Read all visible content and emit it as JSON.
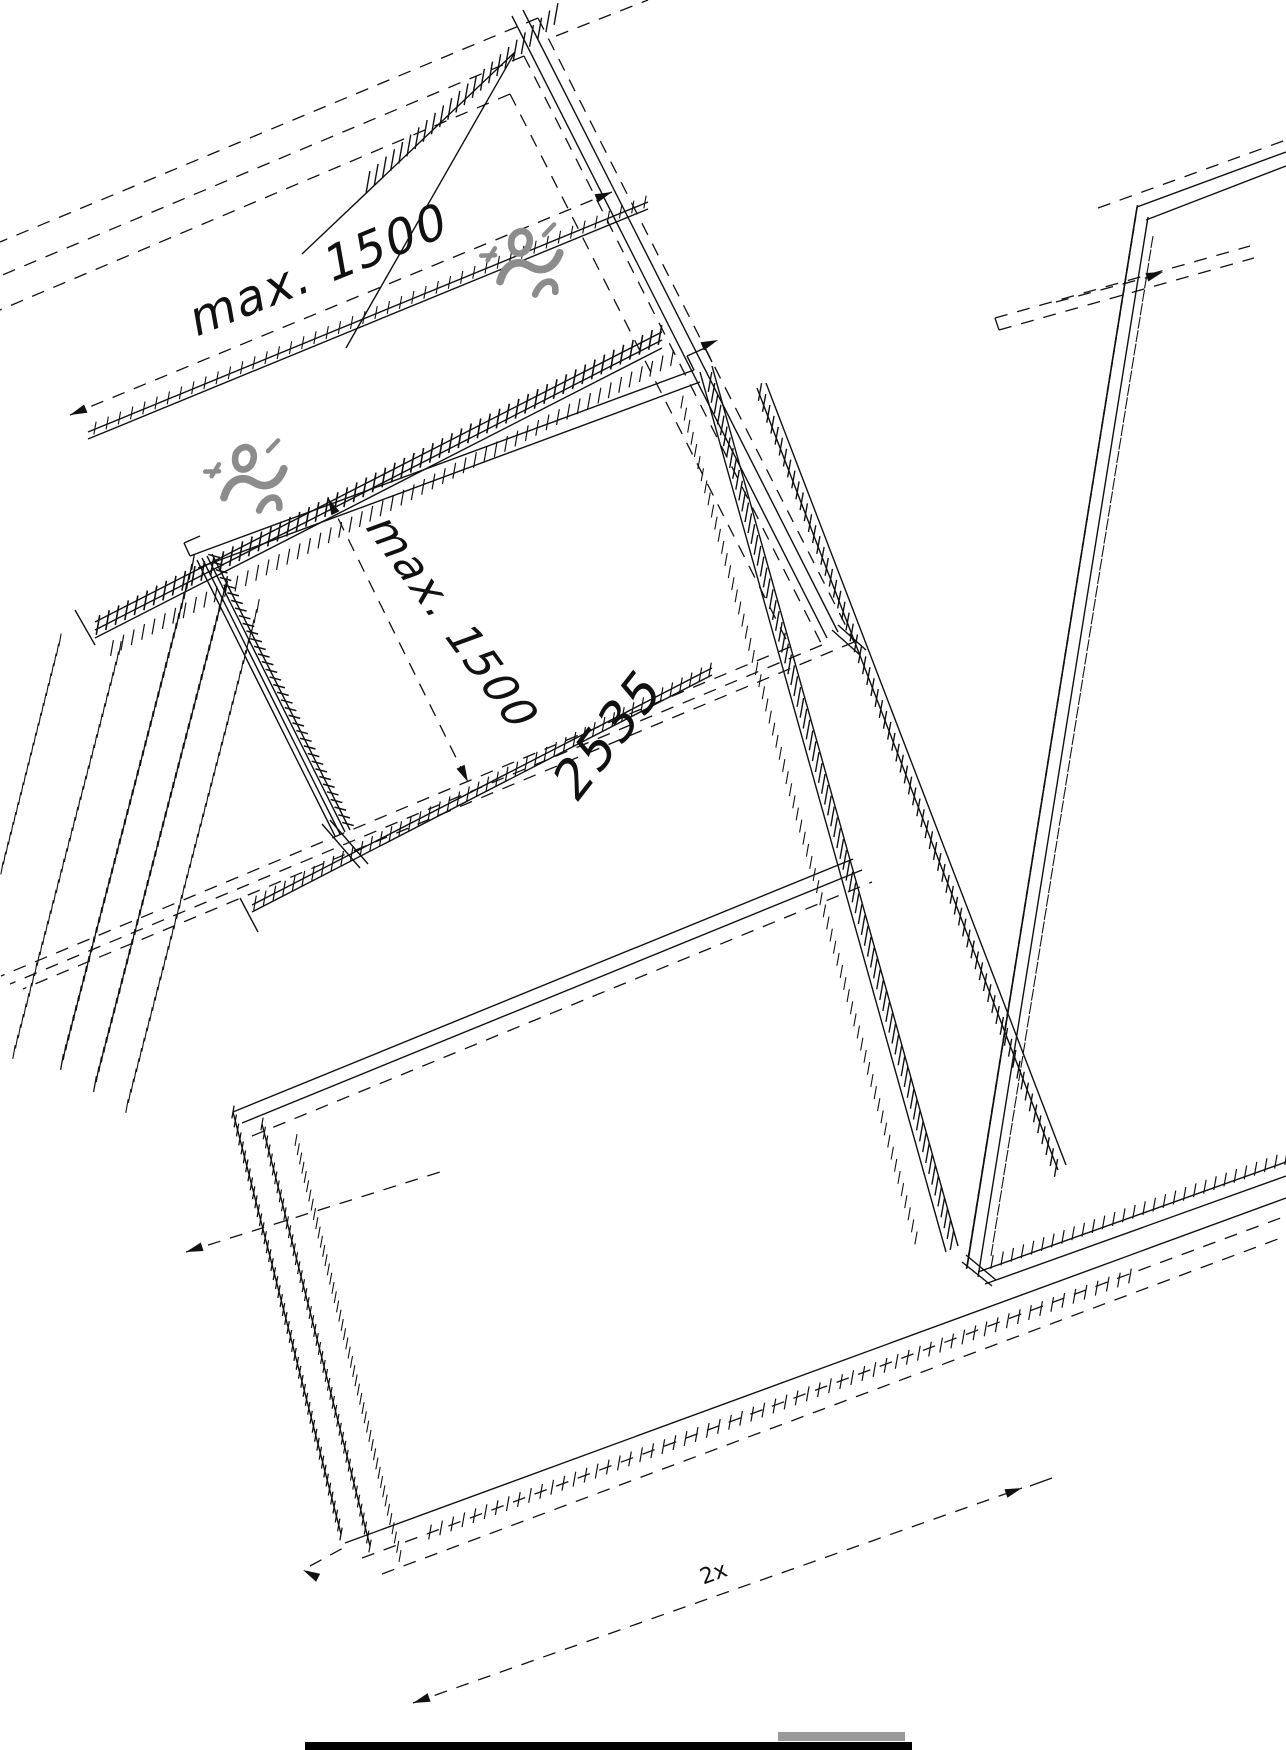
{
  "drawing": {
    "dimension_labels": {
      "top": "max. 1500",
      "middle": "max. 1500"
    },
    "panel_label": "2535",
    "quantity_label": "2x",
    "colors": {
      "line": "#111111",
      "clamp": "#8c8c8c",
      "bottom_bar": "#000000",
      "bottom_strip": "#9a9a9a",
      "background": "#ffffff"
    },
    "icons": [
      {
        "name": "clamp-icon"
      },
      {
        "name": "clamp-icon"
      }
    ]
  }
}
